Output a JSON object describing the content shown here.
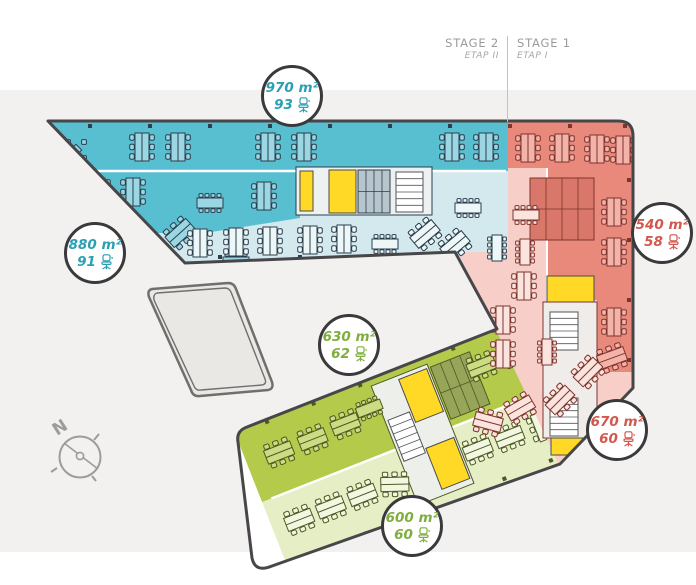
{
  "header": {
    "stage2": {
      "title": "STAGE 2",
      "subtitle": "ETAP II"
    },
    "stage1": {
      "title": "STAGE 1",
      "subtitle": "ETAP I"
    }
  },
  "badges": [
    {
      "zone": "stage2-upper-wing",
      "area": "970 m²",
      "desks": "93",
      "color": "#2a9fb2"
    },
    {
      "zone": "stage2-left-wing",
      "area": "880 m²",
      "desks": "91",
      "color": "#2a9fb2"
    },
    {
      "zone": "stage1-right-wing",
      "area": "540 m²",
      "desks": "58",
      "color": "#d2574d"
    },
    {
      "zone": "stage2-lower-wing",
      "area": "630 m²",
      "desks": "62",
      "color": "#7fae3e"
    },
    {
      "zone": "stage1-lower-wing",
      "area": "670 m²",
      "desks": "60",
      "color": "#d2574d"
    },
    {
      "zone": "stage2-bottom-wing",
      "area": "600 m²",
      "desks": "60",
      "color": "#7fae3e"
    }
  ],
  "compass": {
    "label": "N"
  },
  "colors": {
    "teal-dark": "#58bfd1",
    "teal-light": "#d3e9ee",
    "red-dark": "#e9897c",
    "red-light": "#f8cfc8",
    "green-dark": "#b4ca4b",
    "green-light": "#e6eec5",
    "yellow": "#ffd926",
    "band": "#f2f1ef",
    "outline": "#4a4a4c"
  }
}
